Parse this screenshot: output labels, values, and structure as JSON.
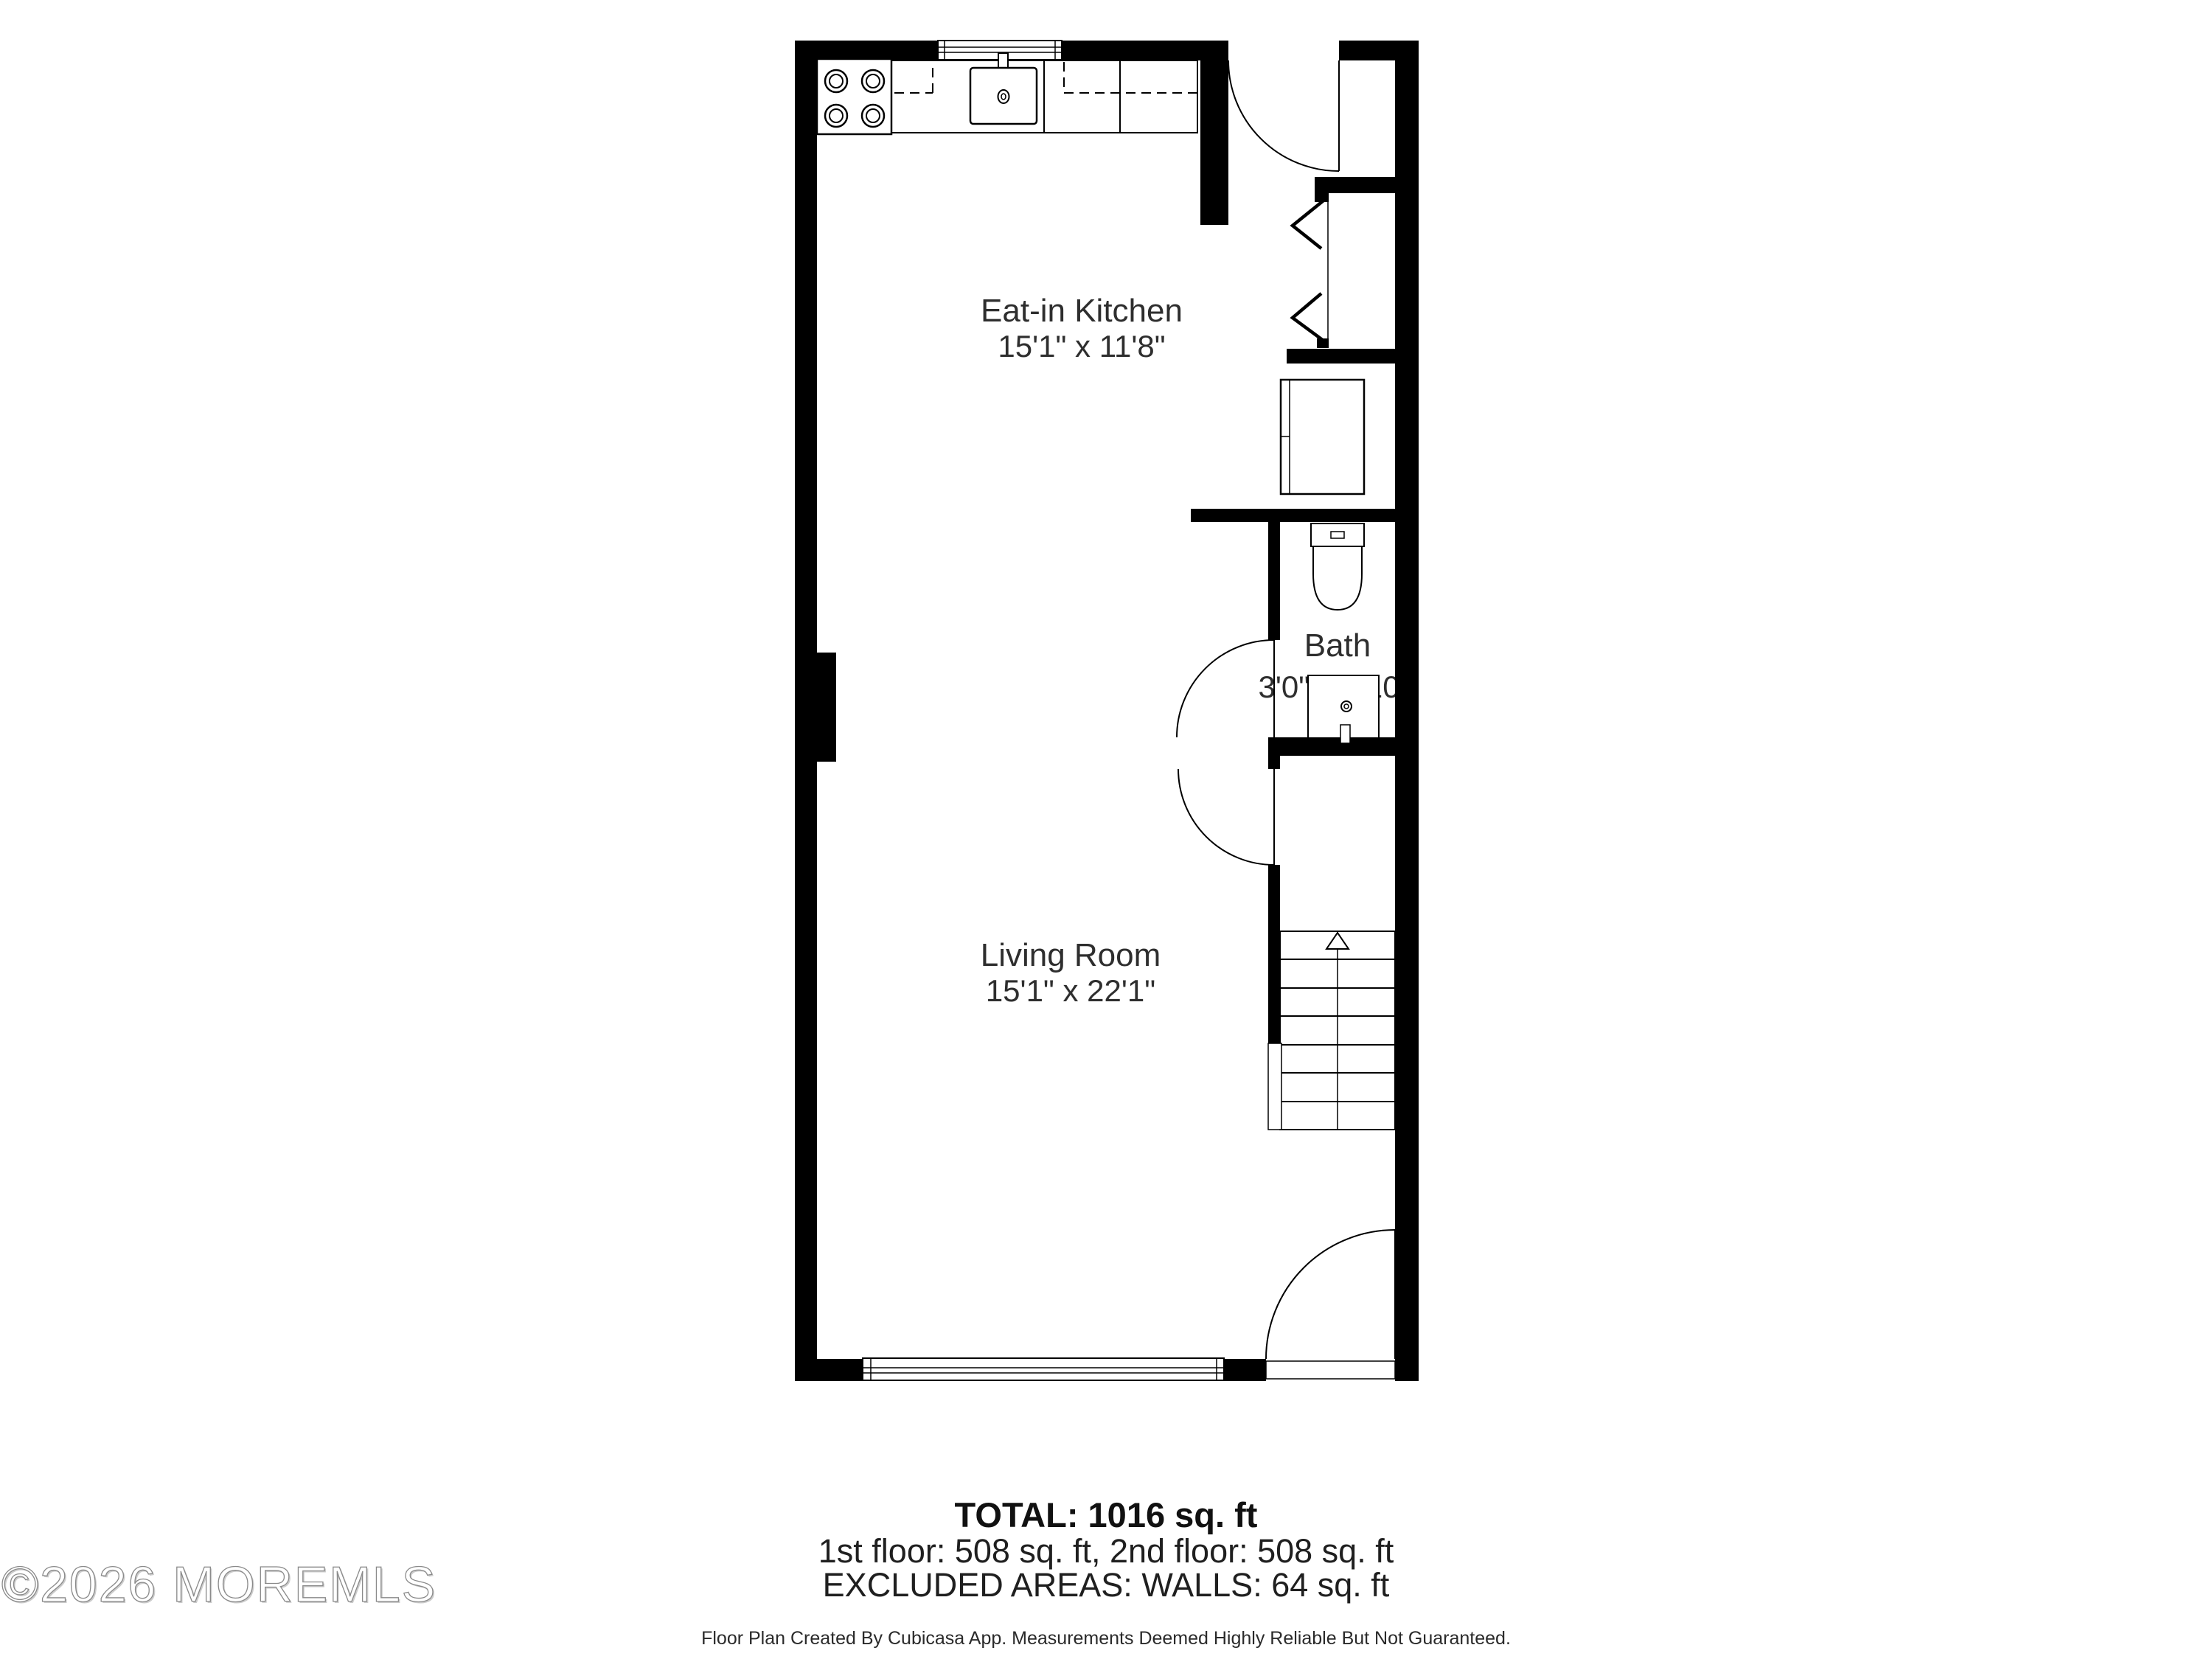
{
  "floor_plan": {
    "rooms": [
      {
        "name": "Eat-in Kitchen",
        "dimensions": "15'1\" x 11'8\""
      },
      {
        "name": "Bath",
        "dimensions": "3'0\" x 5'10\""
      },
      {
        "name": "Living Room",
        "dimensions": "15'1\" x 22'1\""
      }
    ],
    "fixtures": [
      "stove-icon",
      "sink-icon",
      "fridge-icon",
      "kitchen-counter",
      "upper-cabinets-dashed-line",
      "toilet-icon",
      "vanity-sink-icon",
      "stairs-icon",
      "stair-direction-arrow-icon",
      "stair-railing",
      "entry-door-icon",
      "front-door-icon",
      "bath-door-icon",
      "understair-door-icon",
      "closet-bifold-door-icon",
      "kitchen-window-icon",
      "living-room-window-icon",
      "front-door-threshold"
    ],
    "colors": {
      "walls": "#000000",
      "lines": "#000000",
      "floor": "#ffffff",
      "label_text": "#2e2e2e"
    }
  },
  "summary": {
    "total": "TOTAL: 1016 sq. ft",
    "floors": "1st floor: 508 sq. ft, 2nd floor: 508 sq. ft",
    "excluded": "EXCLUDED AREAS: WALLS: 64 sq. ft"
  },
  "disclaimer": "Floor Plan Created By Cubicasa App. Measurements Deemed Highly Reliable But Not Guaranteed.",
  "watermark": "©2026 MOREMLS"
}
